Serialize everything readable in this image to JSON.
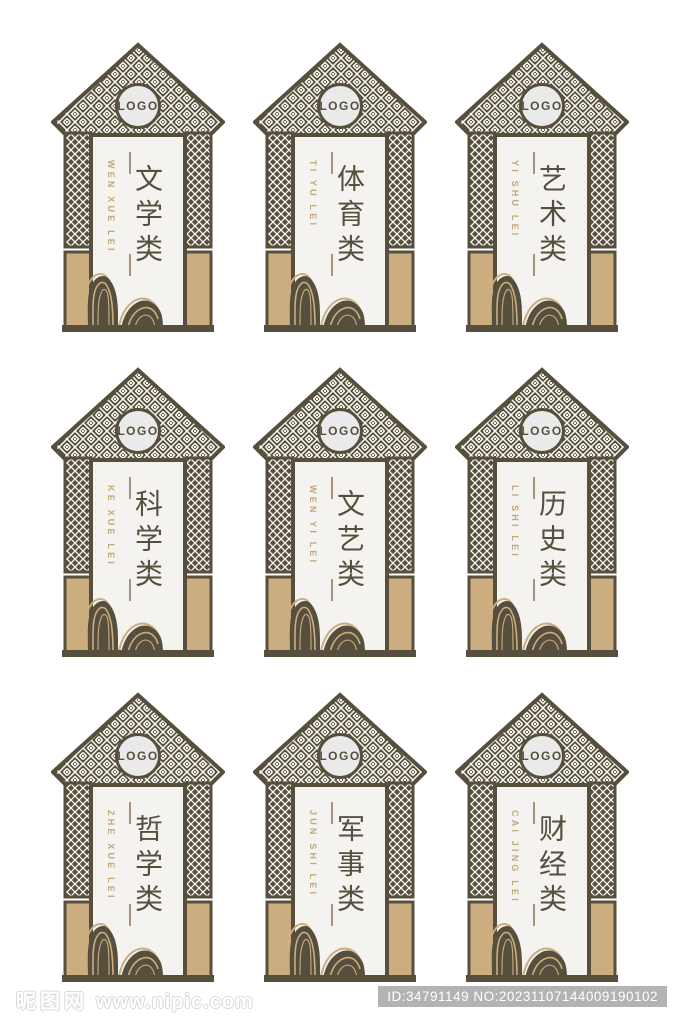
{
  "logo_label": "LOGO",
  "cards": [
    {
      "title": "文学类",
      "pinyin": "WEN XUE LEI"
    },
    {
      "title": "体育类",
      "pinyin": "TI YU LEI"
    },
    {
      "title": "艺术类",
      "pinyin": "YI SHU LEI"
    },
    {
      "title": "科学类",
      "pinyin": "KE XUE LEI"
    },
    {
      "title": "文艺类",
      "pinyin": "WEN YI LEI"
    },
    {
      "title": "历史类",
      "pinyin": "LI SHI LEI"
    },
    {
      "title": "哲学类",
      "pinyin": "ZHE XUE LEI"
    },
    {
      "title": "军事类",
      "pinyin": "JUN SHI LEI"
    },
    {
      "title": "财经类",
      "pinyin": "CAI JING LEI"
    }
  ],
  "footer": {
    "watermark_site_name": "昵图网",
    "watermark_url": "www.nipic.com",
    "id_badge": "ID:34791149 NO:20231107144009190102"
  },
  "colors": {
    "frame_brown": "#574f3e",
    "column_tan": "#cbad7f",
    "panel_background": "#f4f3f0",
    "logo_circle": "#eaeaea",
    "pinyin_gold": "#c3a87a",
    "divider_line": "#a5937d",
    "badge_gray": "#b3b3b3"
  }
}
